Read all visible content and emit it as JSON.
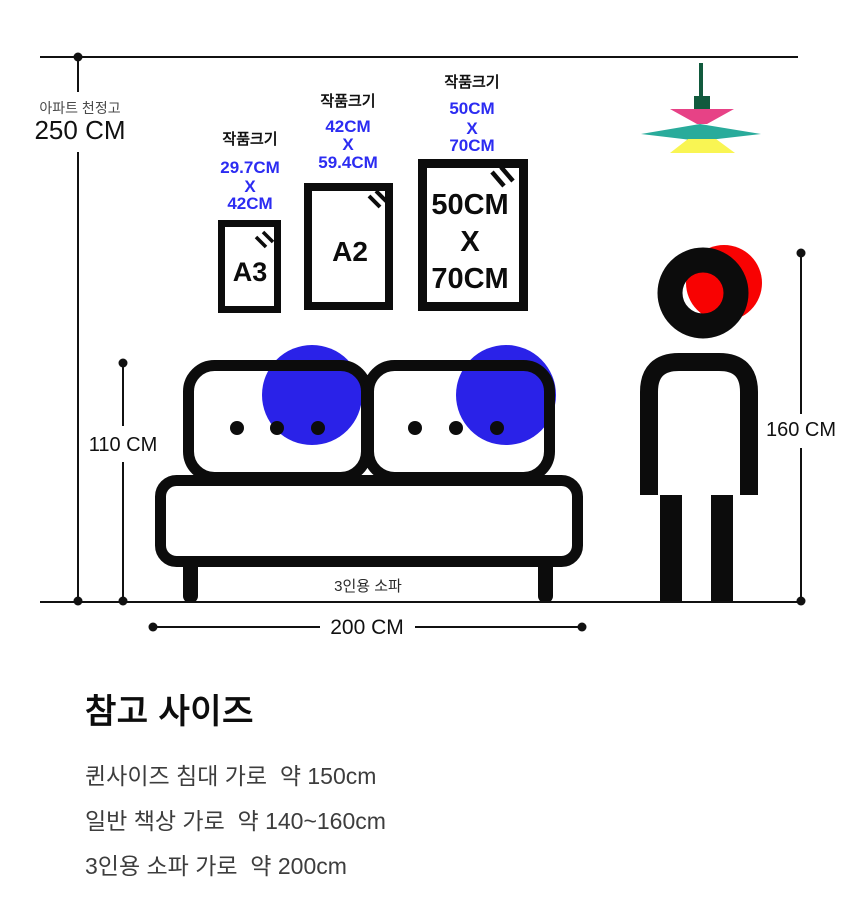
{
  "colors": {
    "black": "#0c0c0c",
    "blue_text": "#2c2cf2",
    "blue_circle": "#2a22e8",
    "red": "#f80202",
    "pink": "#e74286",
    "teal": "#29ab9b",
    "yellow": "#f9f553",
    "stem_green": "#115a3d",
    "gray_label": "#4a4a4a",
    "body_text": "#3d3d3d"
  },
  "ceiling": {
    "label": "아파트 천정고",
    "height": "250 CM"
  },
  "measurements": {
    "sofa_height": "110 CM",
    "person_height": "160 CM",
    "sofa_width": "200 CM"
  },
  "frames": {
    "a3": {
      "label": "작품크기",
      "dim1": "29.7CM",
      "dim2": "X",
      "dim3": "42CM",
      "name": "A3"
    },
    "a2": {
      "label": "작품크기",
      "dim1": "42CM",
      "dim2": "X",
      "dim3": "59.4CM",
      "name": "A2"
    },
    "f5070": {
      "label": "작품크기",
      "dim1": "50CM",
      "dim2": "X",
      "dim3": "70CM",
      "inner1": "50CM",
      "inner2": "X",
      "inner3": "70CM"
    }
  },
  "sofa": {
    "label": "3인용 소파"
  },
  "reference": {
    "heading": "참고 사이즈",
    "items": [
      "퀸사이즈 침대 가로  약 150cm",
      "일반 책상 가로  약 140~160cm",
      "3인용 소파 가로  약 200cm"
    ]
  }
}
